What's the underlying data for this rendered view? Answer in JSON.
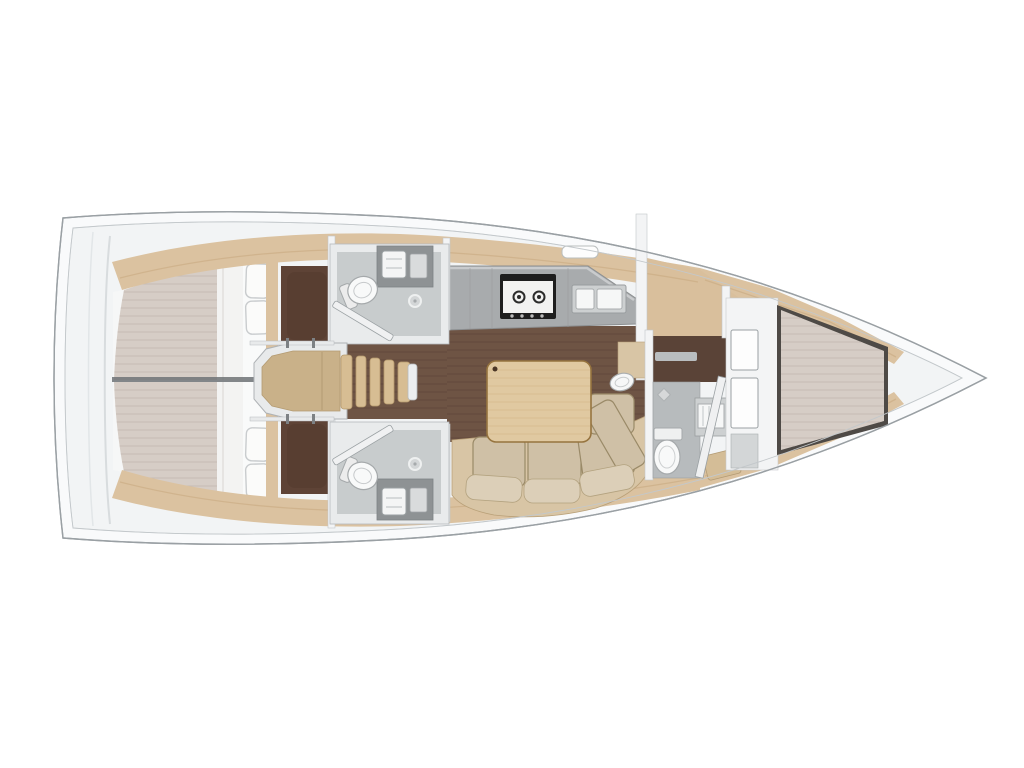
{
  "canvas": {
    "width": 1024,
    "height": 768,
    "background": "#ffffff"
  },
  "diagram": {
    "kind": "sailboat-interior-floor-plan",
    "orientation": "bow-right",
    "features": [
      "hull-outline",
      "side-decks",
      "aft-double-cabin-port",
      "aft-double-cabin-starboard",
      "aft-head-port-with-shower",
      "aft-head-starboard-with-shower",
      "companionway-stairs",
      "galley-two-burner-stove",
      "galley-double-sink",
      "saloon-table",
      "saloon-l-shaped-sofa",
      "wash-basin",
      "forward-head-with-toilet-and-sink",
      "forward-v-berth-cabin",
      "bow-locker"
    ]
  },
  "colors": {
    "bg": "#ffffff",
    "outline": "#9aa0a4",
    "hull": "#f9fafb",
    "deck": "#f2f4f5",
    "band_tan": "#dbc2a0",
    "band_streak": "#c7a87e",
    "cabinet_tan": "#d9bf9c",
    "wood_platform": "#c9b189",
    "wood_step": "#d7bd93",
    "floor_dark": "#5e4336",
    "floor_mid": "#6e5444",
    "plank": "#4e372b",
    "mattress": "#d6cdc6",
    "mattress_line": "#c3b8af",
    "linen": "#f3f3f2",
    "pillow": "#fbfbfa",
    "wall": "#f3f4f5",
    "wall_edge": "#c2c6c8",
    "bath_wall": "#e9ebec",
    "bath_floor": "#c8cccd",
    "bath_floor_dark": "#b7bbbd",
    "vanity": "#8e9294",
    "fixture": "#f8f9f9",
    "fixture_stroke": "#a5a9ab",
    "counter": "#a8abad",
    "counter_edge": "#8c8f91",
    "stove_frame": "#1e1e1e",
    "stove_face": "#f2f2f1",
    "sofa_base": "#d8c5a5",
    "cushion": "#cfc0a6",
    "cushion_light": "#dccfb8",
    "cushion_edge": "#9a8a68",
    "table": "#e0c9a1",
    "table_edge": "#96743f",
    "divider": "#6e7276",
    "metal": "#7d8184"
  }
}
